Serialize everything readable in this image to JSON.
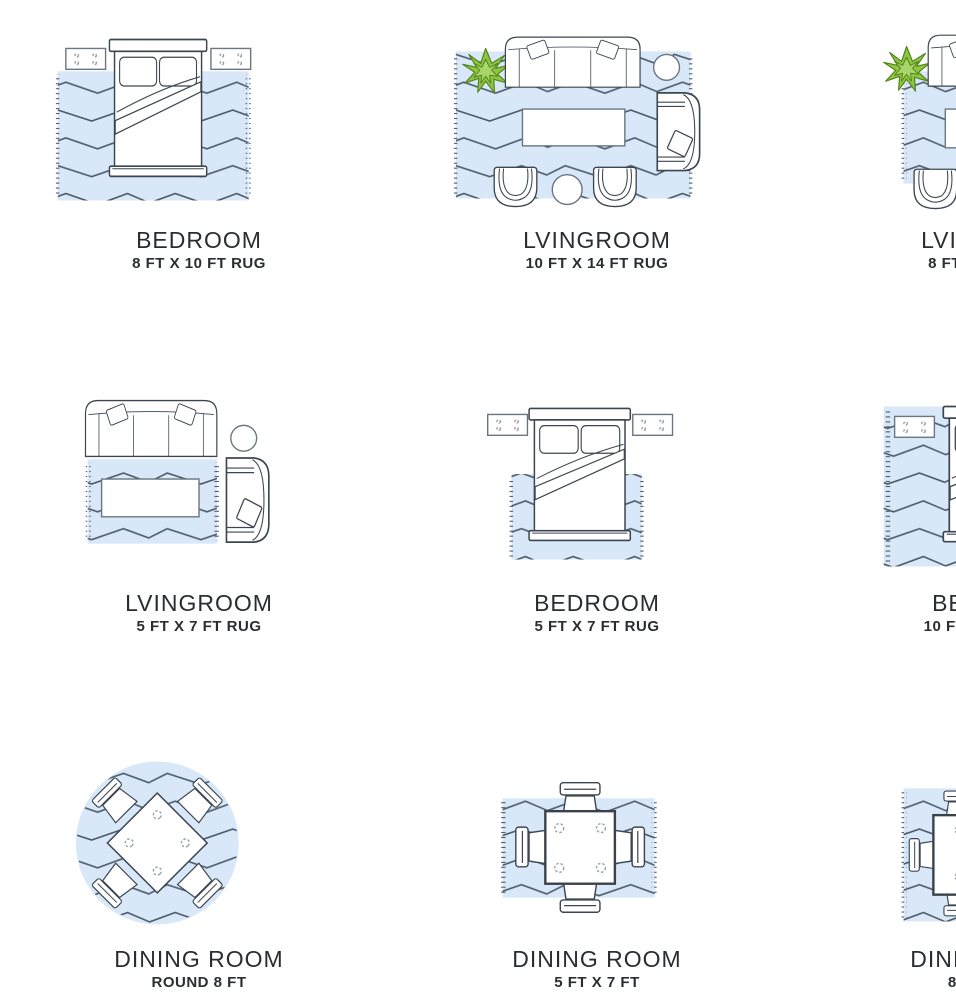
{
  "page": {
    "background": "#ffffff"
  },
  "colors": {
    "rug_fill": "#d8e8f8",
    "rug_zigzag": "#4c5a68",
    "furniture_stroke": "#3c4650",
    "light_stroke": "#6a7681",
    "knob_stroke": "#97a1aa",
    "plant_green": "#8dc63f",
    "plant_green_dark": "#55841f",
    "text": "#2b2e31"
  },
  "cells": [
    {
      "id": "bedroom-8x10",
      "title": "BEDROOM",
      "subtitle": "8 FT X 10 FT RUG",
      "illustration": "bedroom-rug-8x10-diagram"
    },
    {
      "id": "livingroom-10x14",
      "title": "LVINGROOM",
      "subtitle": "10 FT X 14 FT RUG",
      "illustration": "livingroom-rug-10x14-diagram"
    },
    {
      "id": "livingroom-8x10",
      "title": "LVINGROOM",
      "subtitle": "8 FT X 10 FT RUG",
      "illustration": "livingroom-rug-8x10-diagram"
    },
    {
      "id": "livingroom-5x7",
      "title": "LVINGROOM",
      "subtitle": "5 FT X 7 FT RUG",
      "illustration": "livingroom-rug-5x7-diagram"
    },
    {
      "id": "bedroom-5x7",
      "title": "BEDROOM",
      "subtitle": "5 FT X 7 FT RUG",
      "illustration": "bedroom-rug-5x7-diagram"
    },
    {
      "id": "bedroom-10x14",
      "title": "BEDROOM",
      "subtitle": "10 FT X 14 FT RUG",
      "illustration": "bedroom-rug-10x14-diagram"
    },
    {
      "id": "dining-round-8",
      "title": "DINING ROOM",
      "subtitle": "ROUND 8 FT",
      "illustration": "diningroom-rug-round-8-diagram"
    },
    {
      "id": "dining-5x7",
      "title": "DINING ROOM",
      "subtitle": "5 FT X 7 FT",
      "illustration": "diningroom-rug-5x7-diagram"
    },
    {
      "id": "dining-8x10",
      "title": "DINING ROOM",
      "subtitle": "8 FT X 10 FT",
      "illustration": "diningroom-rug-8x10-diagram"
    }
  ]
}
